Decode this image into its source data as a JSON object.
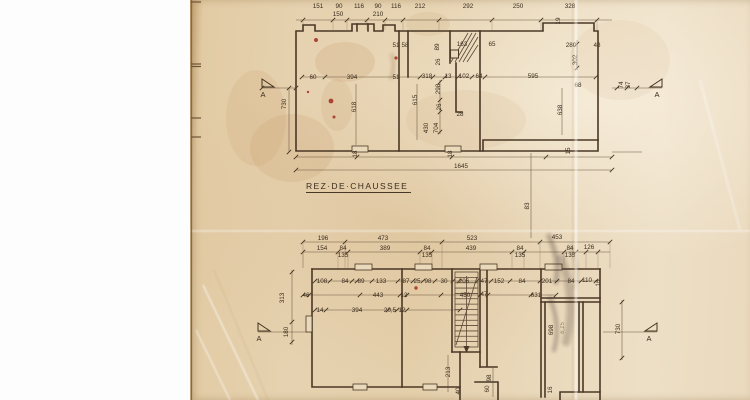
{
  "document": {
    "title": "REZ·DE·CHAUSSEE"
  },
  "colors": {
    "background": "#ffffff",
    "paper": "#e7d4b2",
    "ink": "#4a3826",
    "stain_red": "#9b2415",
    "pencil": "#8d7c62"
  },
  "ground_floor": {
    "labels": [
      {
        "t": "151",
        "x": 318,
        "y": 8
      },
      {
        "t": "90",
        "x": 339,
        "y": 8
      },
      {
        "t": "116",
        "x": 359,
        "y": 8
      },
      {
        "t": "90",
        "x": 378,
        "y": 8
      },
      {
        "t": "116",
        "x": 396,
        "y": 8
      },
      {
        "t": "212",
        "x": 420,
        "y": 8
      },
      {
        "t": "292",
        "x": 468,
        "y": 8
      },
      {
        "t": "250",
        "x": 518,
        "y": 8
      },
      {
        "t": "328",
        "x": 570,
        "y": 8
      },
      {
        "t": "150",
        "x": 338,
        "y": 16
      },
      {
        "t": "210",
        "x": 378,
        "y": 16
      },
      {
        "t": "19",
        "x": 560,
        "y": 21,
        "r": 1
      },
      {
        "t": "51",
        "x": 396,
        "y": 47
      },
      {
        "t": "58",
        "x": 405,
        "y": 47
      },
      {
        "t": "89",
        "x": 439,
        "y": 47,
        "r": 1
      },
      {
        "t": "163",
        "x": 462,
        "y": 46
      },
      {
        "t": "65",
        "x": 492,
        "y": 46
      },
      {
        "t": "26",
        "x": 440,
        "y": 62,
        "r": 1
      },
      {
        "t": "280",
        "x": 571,
        "y": 47
      },
      {
        "t": "48",
        "x": 597,
        "y": 47
      },
      {
        "t": "302",
        "x": 577,
        "y": 60,
        "r": 1
      },
      {
        "t": "60",
        "x": 313,
        "y": 79
      },
      {
        "t": "394",
        "x": 352,
        "y": 79
      },
      {
        "t": "51",
        "x": 396,
        "y": 79
      },
      {
        "t": "318",
        "x": 427,
        "y": 78
      },
      {
        "t": "13",
        "x": 448,
        "y": 78
      },
      {
        "t": "102",
        "x": 464,
        "y": 78
      },
      {
        "t": "64",
        "x": 479,
        "y": 78
      },
      {
        "t": "595",
        "x": 533,
        "y": 78
      },
      {
        "t": "298",
        "x": 440,
        "y": 89,
        "r": 1
      },
      {
        "t": "615",
        "x": 417,
        "y": 100,
        "r": 1
      },
      {
        "t": "618",
        "x": 356,
        "y": 107,
        "r": 1
      },
      {
        "t": "26",
        "x": 441,
        "y": 107,
        "r": 1
      },
      {
        "t": "28",
        "x": 460,
        "y": 116
      },
      {
        "t": "430",
        "x": 428,
        "y": 128,
        "r": 1
      },
      {
        "t": "704",
        "x": 438,
        "y": 128,
        "r": 1
      },
      {
        "t": "638",
        "x": 562,
        "y": 110,
        "r": 1
      },
      {
        "t": "68",
        "x": 578,
        "y": 87
      },
      {
        "t": "74",
        "x": 623,
        "y": 85,
        "r": 1
      },
      {
        "t": "37",
        "x": 630,
        "y": 85,
        "r": 1
      },
      {
        "t": "730",
        "x": 286,
        "y": 104,
        "r": 1
      },
      {
        "t": "18",
        "x": 357,
        "y": 154,
        "r": 1
      },
      {
        "t": "18",
        "x": 452,
        "y": 154,
        "r": 1
      },
      {
        "t": "15",
        "x": 570,
        "y": 151,
        "r": 1
      },
      {
        "t": "1645",
        "x": 461,
        "y": 168
      },
      {
        "t": "83",
        "x": 529,
        "y": 206,
        "r": 1
      }
    ]
  },
  "lower_floor": {
    "labels": [
      {
        "t": "196",
        "x": 323,
        "y": 240
      },
      {
        "t": "473",
        "x": 383,
        "y": 240
      },
      {
        "t": "523",
        "x": 472,
        "y": 240
      },
      {
        "t": "453",
        "x": 557,
        "y": 239
      },
      {
        "t": "154",
        "x": 322,
        "y": 250
      },
      {
        "t": "84",
        "x": 343,
        "y": 250
      },
      {
        "t": "389",
        "x": 385,
        "y": 250
      },
      {
        "t": "84",
        "x": 427,
        "y": 250
      },
      {
        "t": "439",
        "x": 471,
        "y": 250
      },
      {
        "t": "84",
        "x": 520,
        "y": 250
      },
      {
        "t": "84",
        "x": 570,
        "y": 250
      },
      {
        "t": "126",
        "x": 589,
        "y": 249
      },
      {
        "t": "135",
        "x": 343,
        "y": 257
      },
      {
        "t": "135",
        "x": 427,
        "y": 257
      },
      {
        "t": "135",
        "x": 520,
        "y": 257
      },
      {
        "t": "135",
        "x": 570,
        "y": 257
      },
      {
        "t": "108",
        "x": 322,
        "y": 283
      },
      {
        "t": "84",
        "x": 345,
        "y": 283
      },
      {
        "t": "89",
        "x": 361,
        "y": 283
      },
      {
        "t": "133",
        "x": 381,
        "y": 283
      },
      {
        "t": "87",
        "x": 406,
        "y": 283
      },
      {
        "t": "25",
        "x": 417,
        "y": 283
      },
      {
        "t": "98",
        "x": 428,
        "y": 283
      },
      {
        "t": "30",
        "x": 444,
        "y": 283
      },
      {
        "t": "206",
        "x": 464,
        "y": 283
      },
      {
        "t": "47",
        "x": 484,
        "y": 283
      },
      {
        "t": "152",
        "x": 499,
        "y": 283
      },
      {
        "t": "84",
        "x": 522,
        "y": 283
      },
      {
        "t": "201",
        "x": 547,
        "y": 283
      },
      {
        "t": "84",
        "x": 571,
        "y": 283
      },
      {
        "t": "110",
        "x": 587,
        "y": 282
      },
      {
        "t": "16",
        "x": 600,
        "y": 283,
        "r": 1
      },
      {
        "t": "46",
        "x": 306,
        "y": 297
      },
      {
        "t": "443",
        "x": 378,
        "y": 297
      },
      {
        "t": "12",
        "x": 404,
        "y": 297
      },
      {
        "t": "450",
        "x": 465,
        "y": 297
      },
      {
        "t": "47",
        "x": 484,
        "y": 296
      },
      {
        "t": "631",
        "x": 536,
        "y": 297
      },
      {
        "t": "14",
        "x": 320,
        "y": 312
      },
      {
        "t": "394",
        "x": 357,
        "y": 312
      },
      {
        "t": "20,5",
        "x": 390,
        "y": 312
      },
      {
        "t": "12",
        "x": 402,
        "y": 312
      },
      {
        "t": "313",
        "x": 284,
        "y": 298,
        "r": 1
      },
      {
        "t": "180",
        "x": 288,
        "y": 332,
        "r": 1
      },
      {
        "t": "698",
        "x": 553,
        "y": 330,
        "r": 1
      },
      {
        "t": "730",
        "x": 620,
        "y": 329,
        "r": 1
      },
      {
        "t": "213",
        "x": 450,
        "y": 372,
        "r": 1
      },
      {
        "t": "98",
        "x": 491,
        "y": 378,
        "r": 1
      },
      {
        "t": "60",
        "x": 489,
        "y": 389,
        "r": 1
      },
      {
        "t": "40",
        "x": 460,
        "y": 391,
        "r": 1
      },
      {
        "t": "16",
        "x": 552,
        "y": 390,
        "r": 1
      },
      {
        "t": "6,15",
        "x": 564,
        "y": 328,
        "r": 1,
        "s": "pencil"
      }
    ]
  },
  "section_markers": [
    {
      "letter": "A",
      "x": 263,
      "y": 97
    },
    {
      "letter": "A",
      "x": 657,
      "y": 97
    },
    {
      "letter": "A",
      "x": 259,
      "y": 341
    },
    {
      "letter": "A",
      "x": 649,
      "y": 341
    }
  ]
}
